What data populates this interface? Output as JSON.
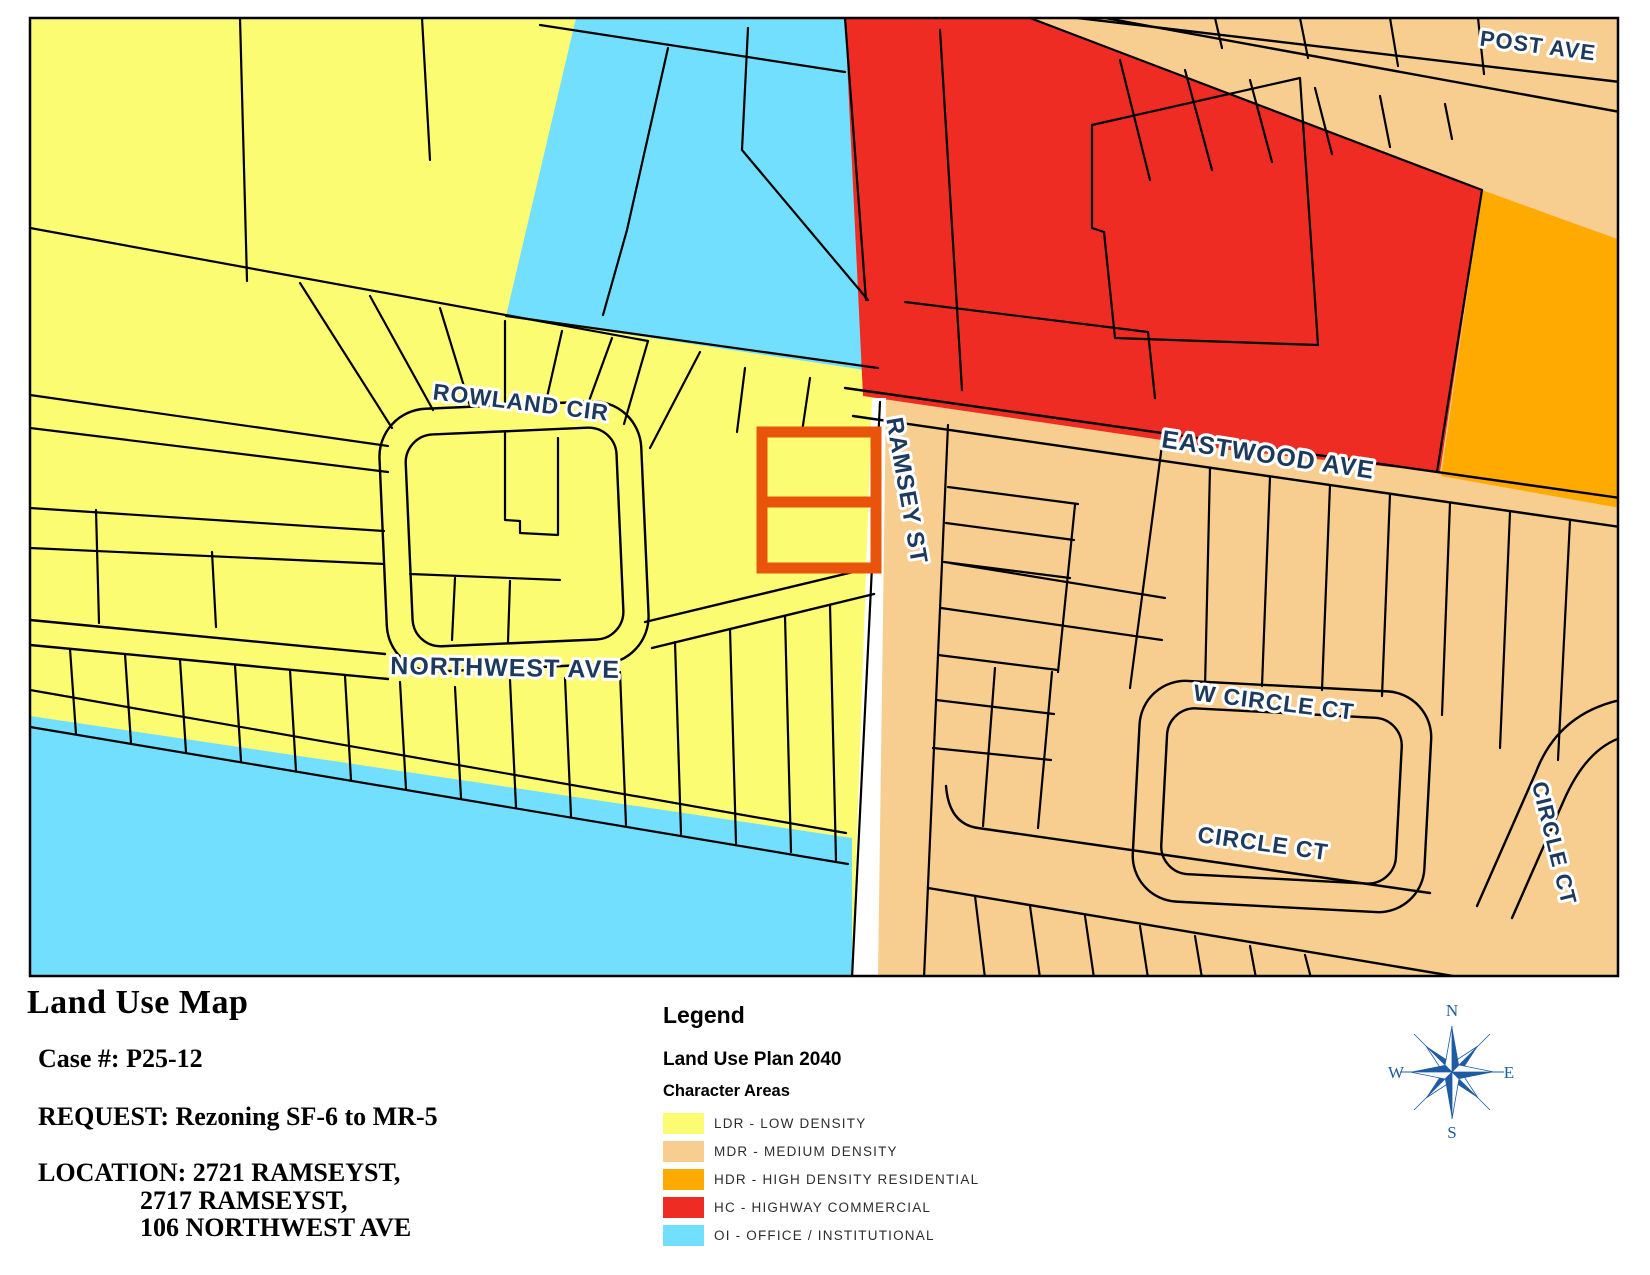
{
  "title_block": {
    "title": "Land Use Map",
    "case_line": "Case #: P25-12",
    "request_line": "REQUEST: Rezoning SF-6 to MR-5",
    "location_line1": "LOCATION: 2721 RAMSEYST,",
    "location_line2": "2717 RAMSEYST,",
    "location_line3": "106 NORTHWEST AVE"
  },
  "legend": {
    "heading": "Legend",
    "subheading": "Land Use Plan 2040",
    "group_label": "Character Areas",
    "items": [
      {
        "label": "LDR - LOW DENSITY",
        "color": "#FCFC73"
      },
      {
        "label": "MDR - MEDIUM DENSITY",
        "color": "#F8CD90"
      },
      {
        "label": "HDR - HIGH DENSITY RESIDENTIAL",
        "color": "#FFAA00"
      },
      {
        "label": "HC - HIGHWAY COMMERCIAL",
        "color": "#EE2C24"
      },
      {
        "label": "OI - OFFICE / INSTITUTIONAL",
        "color": "#73DFFF"
      }
    ]
  },
  "compass": {
    "north": "N",
    "south": "S",
    "east": "E",
    "west": "W",
    "color": "#1D5CA4"
  },
  "map": {
    "streets": {
      "rowland_cir": "ROWLAND CIR",
      "northwest_ave": "NORTHWEST AVE",
      "ramsey_st": "RAMSEY ST",
      "eastwood_ave": "EASTWOOD AVE",
      "post_ave": "POST AVE",
      "w_circle_ct": "W CIRCLE CT",
      "circle_ct": "CIRCLE CT"
    },
    "colors": {
      "ldr": "#FCFC73",
      "mdr": "#F8CD90",
      "hdr": "#FFAA00",
      "hc": "#EE2C24",
      "oi": "#73DFFF",
      "subject_outline": "#E8540A",
      "street_label": "#1C3A5E"
    }
  }
}
